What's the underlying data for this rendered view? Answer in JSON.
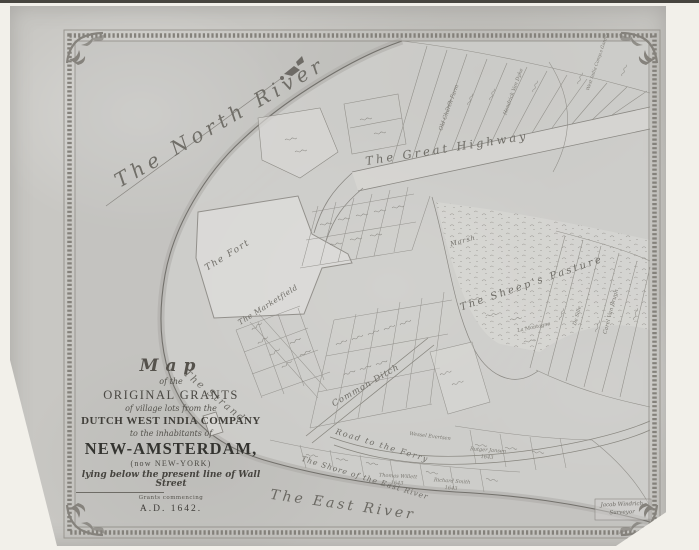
{
  "palette": {
    "paper_margin": "#f2f0ea",
    "map_sheet": "#c8c7c3",
    "frame_gray": "#84817b",
    "engraving_ink": "#8a8883",
    "label_ink": "#6f6d67",
    "title_ink": "#343430"
  },
  "title_block": {
    "map_word": "Map",
    "of_the": "of the",
    "original_grants": "ORIGINAL GRANTS",
    "village_lots": "of village lots from the",
    "company": "DUTCH WEST INDIA COMPANY",
    "inhabitants": "to the inhabitants of",
    "new_amsterdam": "NEW-AMSTERDAM,",
    "new_york": "(now NEW-YORK)",
    "wall_street": "lying below the present line of Wall Street",
    "grants_note": "Grants commencing",
    "date": "A.D. 1642."
  },
  "water_labels": {
    "north_river": "The North River",
    "east_river": "The East River",
    "shore_east_river": "The Shore of the East River"
  },
  "place_labels": {
    "great_highway": "The Great Highway",
    "sheeps_pasture": "The Sheep's Pasture",
    "marsh": "Marsh",
    "fort": "The Fort",
    "marketfield": "The Marketfield",
    "strand": "The Strand",
    "common_ditch": "Common Ditch",
    "road_to_ferry": "Road to the Ferry"
  },
  "parcel_labels": [
    {
      "text": "Old Church Farm"
    },
    {
      "text": "West India Comp.s Garden"
    },
    {
      "text": "Hendrick Van Dyke"
    },
    {
      "text": "Carel Van Brugh"
    },
    {
      "text": "De Sille"
    },
    {
      "text": "La Montagne"
    },
    {
      "text": "Thomas Willett"
    },
    {
      "text": "1643"
    },
    {
      "text": "Richard Smith"
    },
    {
      "text": "1643"
    },
    {
      "text": "Rutger Jansen"
    },
    {
      "text": "1643"
    },
    {
      "text": "Wessel Evertsen"
    }
  ],
  "signature": {
    "line1": "Jacob Windrich",
    "line2": "Surveyor"
  }
}
